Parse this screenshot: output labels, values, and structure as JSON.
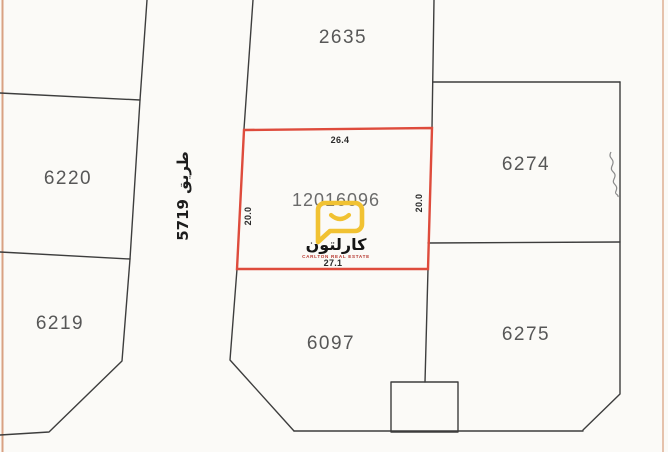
{
  "map": {
    "background_color": "#fbfaf7",
    "boundary_line_color": "#3d3d3d",
    "page_edge_line_color": "#d9a183",
    "plots": [
      {
        "number": "2635"
      },
      {
        "number": "6220"
      },
      {
        "number": "6219"
      },
      {
        "number": "6274"
      },
      {
        "number": "6275"
      },
      {
        "number": "6097"
      }
    ],
    "highlighted_plot": {
      "number": "12016096",
      "outline_color": "#de4b3c",
      "dim_top": "26.4",
      "dim_bottom": "27.1",
      "dim_left": "20.0",
      "dim_right": "20.0"
    },
    "road": {
      "name": "طريق 5719"
    },
    "watermark": {
      "name_arabic": "كارلتون",
      "name_english": "CARLTON REAL ESTATE",
      "logo_color": "#f1c232",
      "arabic_text_color": "#151515",
      "english_text_color": "#b5342c"
    }
  }
}
